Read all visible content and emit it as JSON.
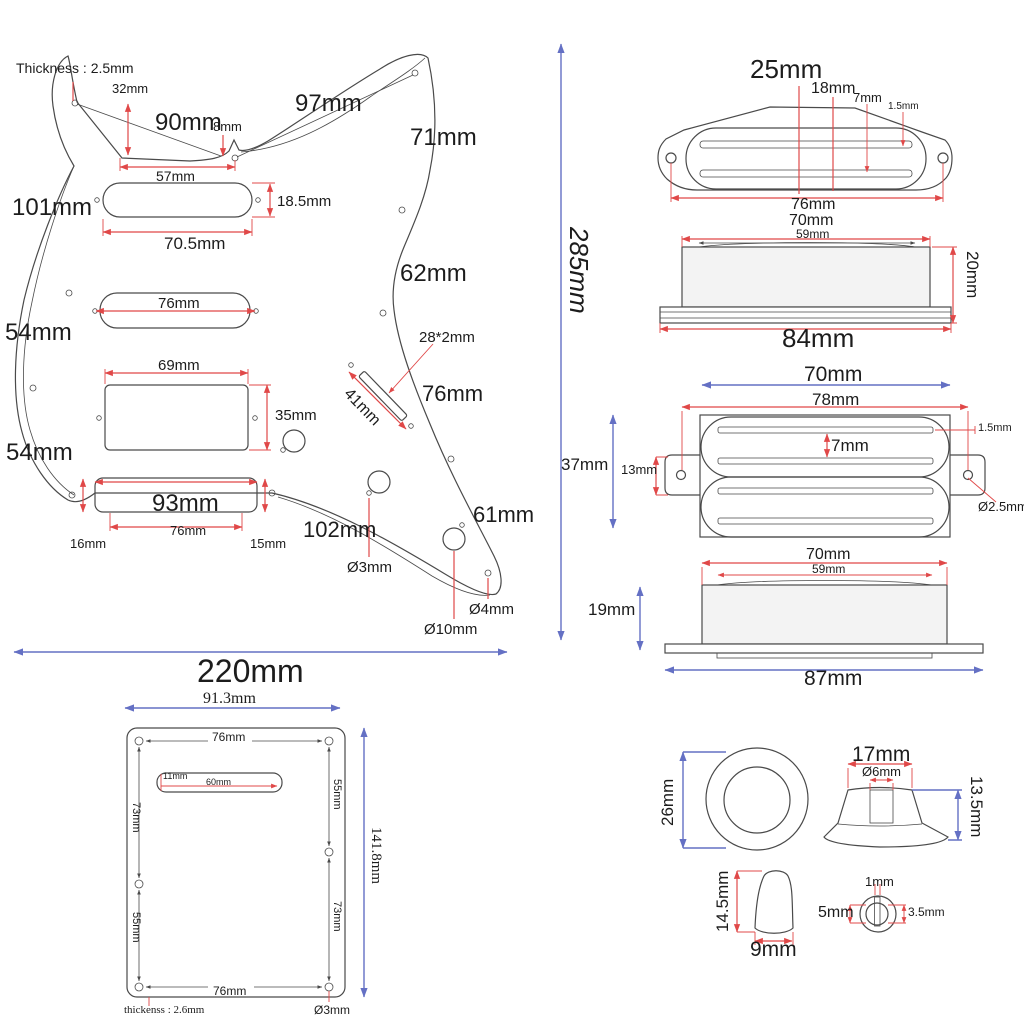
{
  "colors": {
    "dimension_red": "#e04848",
    "dimension_blue": "#6470c4",
    "line": "#4a4a4a"
  },
  "pickguard": {
    "thickness_note": "Thickness : 2.5mm",
    "d32": "32mm",
    "d90": "90mm",
    "d8": "8mm",
    "d57": "57mm",
    "d18_5": "18.5mm",
    "d101": "101mm",
    "d70_5": "70.5mm",
    "d76_mid": "76mm",
    "d54_upper": "54mm",
    "d69": "69mm",
    "d35": "35mm",
    "d54_lower": "54mm",
    "d93": "93mm",
    "d76_bridge": "76mm",
    "d16": "16mm",
    "d15": "15mm",
    "d97": "97mm",
    "d71": "71mm",
    "d62": "62mm",
    "d28x2": "28*2mm",
    "d41": "41mm",
    "d76_right": "76mm",
    "d102": "102mm",
    "d61": "61mm",
    "dia3": "Ø3mm",
    "dia4": "Ø4mm",
    "dia10": "Ø10mm",
    "total_width": "220mm",
    "total_height": "285mm"
  },
  "singlecoil_top": {
    "d25": "25mm",
    "d18": "18mm",
    "d7": "7mm",
    "d1_5": "1.5mm",
    "d76": "76mm"
  },
  "singlecoil_side": {
    "d70": "70mm",
    "d59": "59mm",
    "d20": "20mm",
    "d84": "84mm"
  },
  "humbucker_top": {
    "d70": "70mm",
    "d78": "78mm",
    "d7": "7mm",
    "d1_5": "1.5mm",
    "d13": "13mm",
    "d37": "37mm",
    "dia2_5": "Ø2.5mm"
  },
  "humbucker_side": {
    "d70": "70mm",
    "d59": "59mm",
    "d19": "19mm",
    "d87": "87mm"
  },
  "knobs": {
    "d26": "26mm",
    "d17": "17mm",
    "dia6": "Ø6mm",
    "d13_5": "13.5mm",
    "d14_5": "14.5mm",
    "d9": "9mm",
    "d1": "1mm",
    "d5": "5mm",
    "d3_5": "3.5mm"
  },
  "backplate": {
    "d91_3": "91.3mm",
    "d76_top": "76mm",
    "d11": "11mm",
    "d60": "60mm",
    "d55_right": "55mm",
    "d73_left": "73mm",
    "d141_8": "141.8mm",
    "d55_left": "55mm",
    "d73_right": "73mm",
    "d76_bottom": "76mm",
    "thickness_note": "thickenss : 2.6mm",
    "dia3": "Ø3mm"
  }
}
